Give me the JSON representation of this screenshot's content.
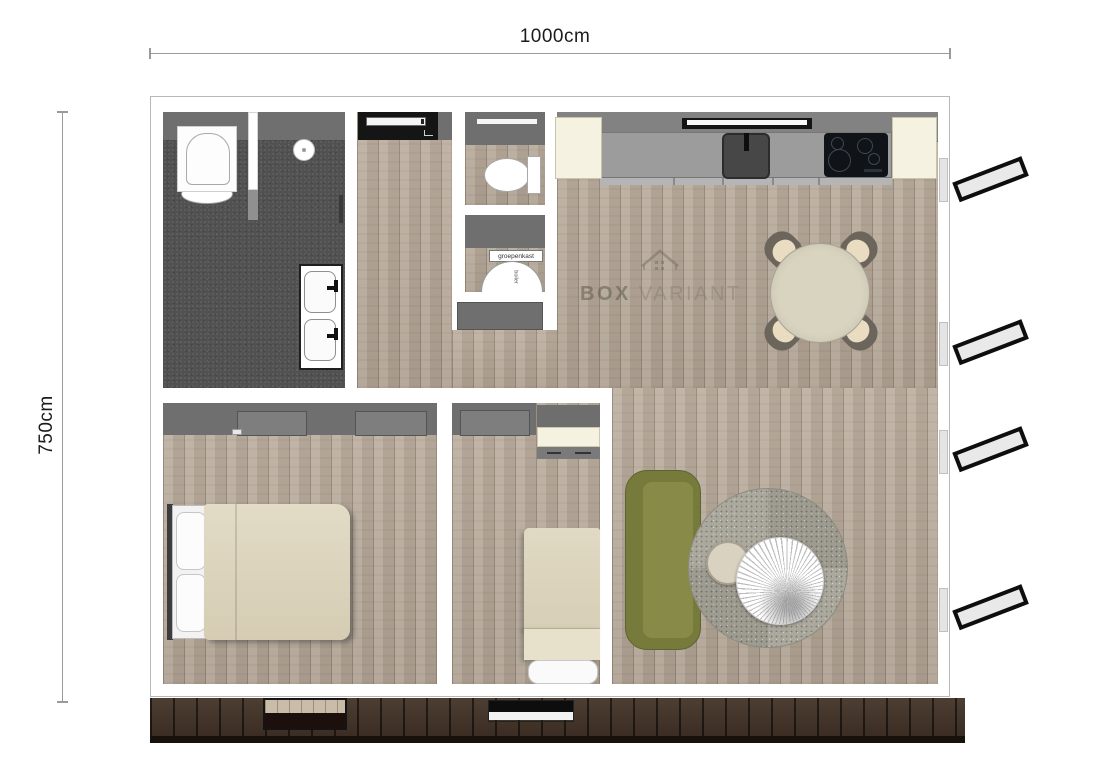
{
  "annotations": {
    "width_label": "1000cm",
    "height_label": "750cm"
  },
  "rooms": {
    "technical": {
      "fuse_box_label": "groepenkast",
      "boiler_label": "boiler"
    }
  },
  "watermark": {
    "brand_bold": "BOX",
    "brand_light": "VARIANT"
  },
  "furniture_icons": [
    "toilet-icon",
    "floor-drain-icon",
    "double-washbasin-icon",
    "wc-toilet-icon",
    "boiler-icon",
    "entrance-door-icon",
    "kitchen-sink-icon",
    "induction-hob-icon",
    "extractor-hood-icon",
    "dining-table-icon",
    "dining-chair-icon",
    "sofa-icon",
    "rug-icon",
    "coffee-table-icon",
    "side-table-icon",
    "double-bed-icon",
    "single-bed-icon",
    "desk-icon",
    "wardrobe-icon",
    "window-shutter-icon",
    "deck-icon"
  ],
  "colors": {
    "wall_gray": "#6f6f6f",
    "wood_floor": "#b9ab9b",
    "tile_floor": "#515151",
    "deck_brown": "#443428",
    "counter_gray": "#9c9c9c",
    "cabinet_cream": "#f6f2e1",
    "cooktop_black": "#101418",
    "sofa_green": "#7b7f3e",
    "textile_cream": "#ded6c0"
  }
}
